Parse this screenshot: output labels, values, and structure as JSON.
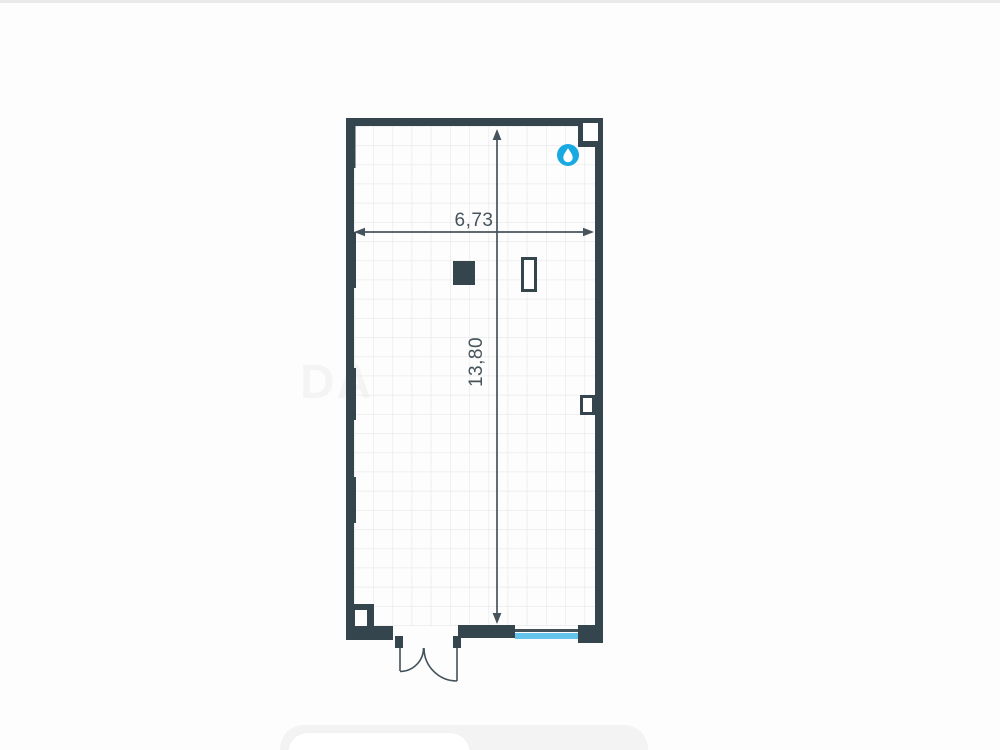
{
  "page": {
    "background": "#fdfdfd",
    "top_divider_color": "#e9e9e9"
  },
  "floorplan": {
    "room": {
      "width_label": "6,73",
      "height_label": "13,80"
    },
    "colors": {
      "wall": "#35454e",
      "dimension": "#47545c",
      "grid": "#e7e7e7",
      "window": "#64c3ea",
      "water_icon": "#1aa9e1"
    },
    "icons": {
      "water_supply": "water-drop-icon"
    },
    "watermark": "DA"
  }
}
